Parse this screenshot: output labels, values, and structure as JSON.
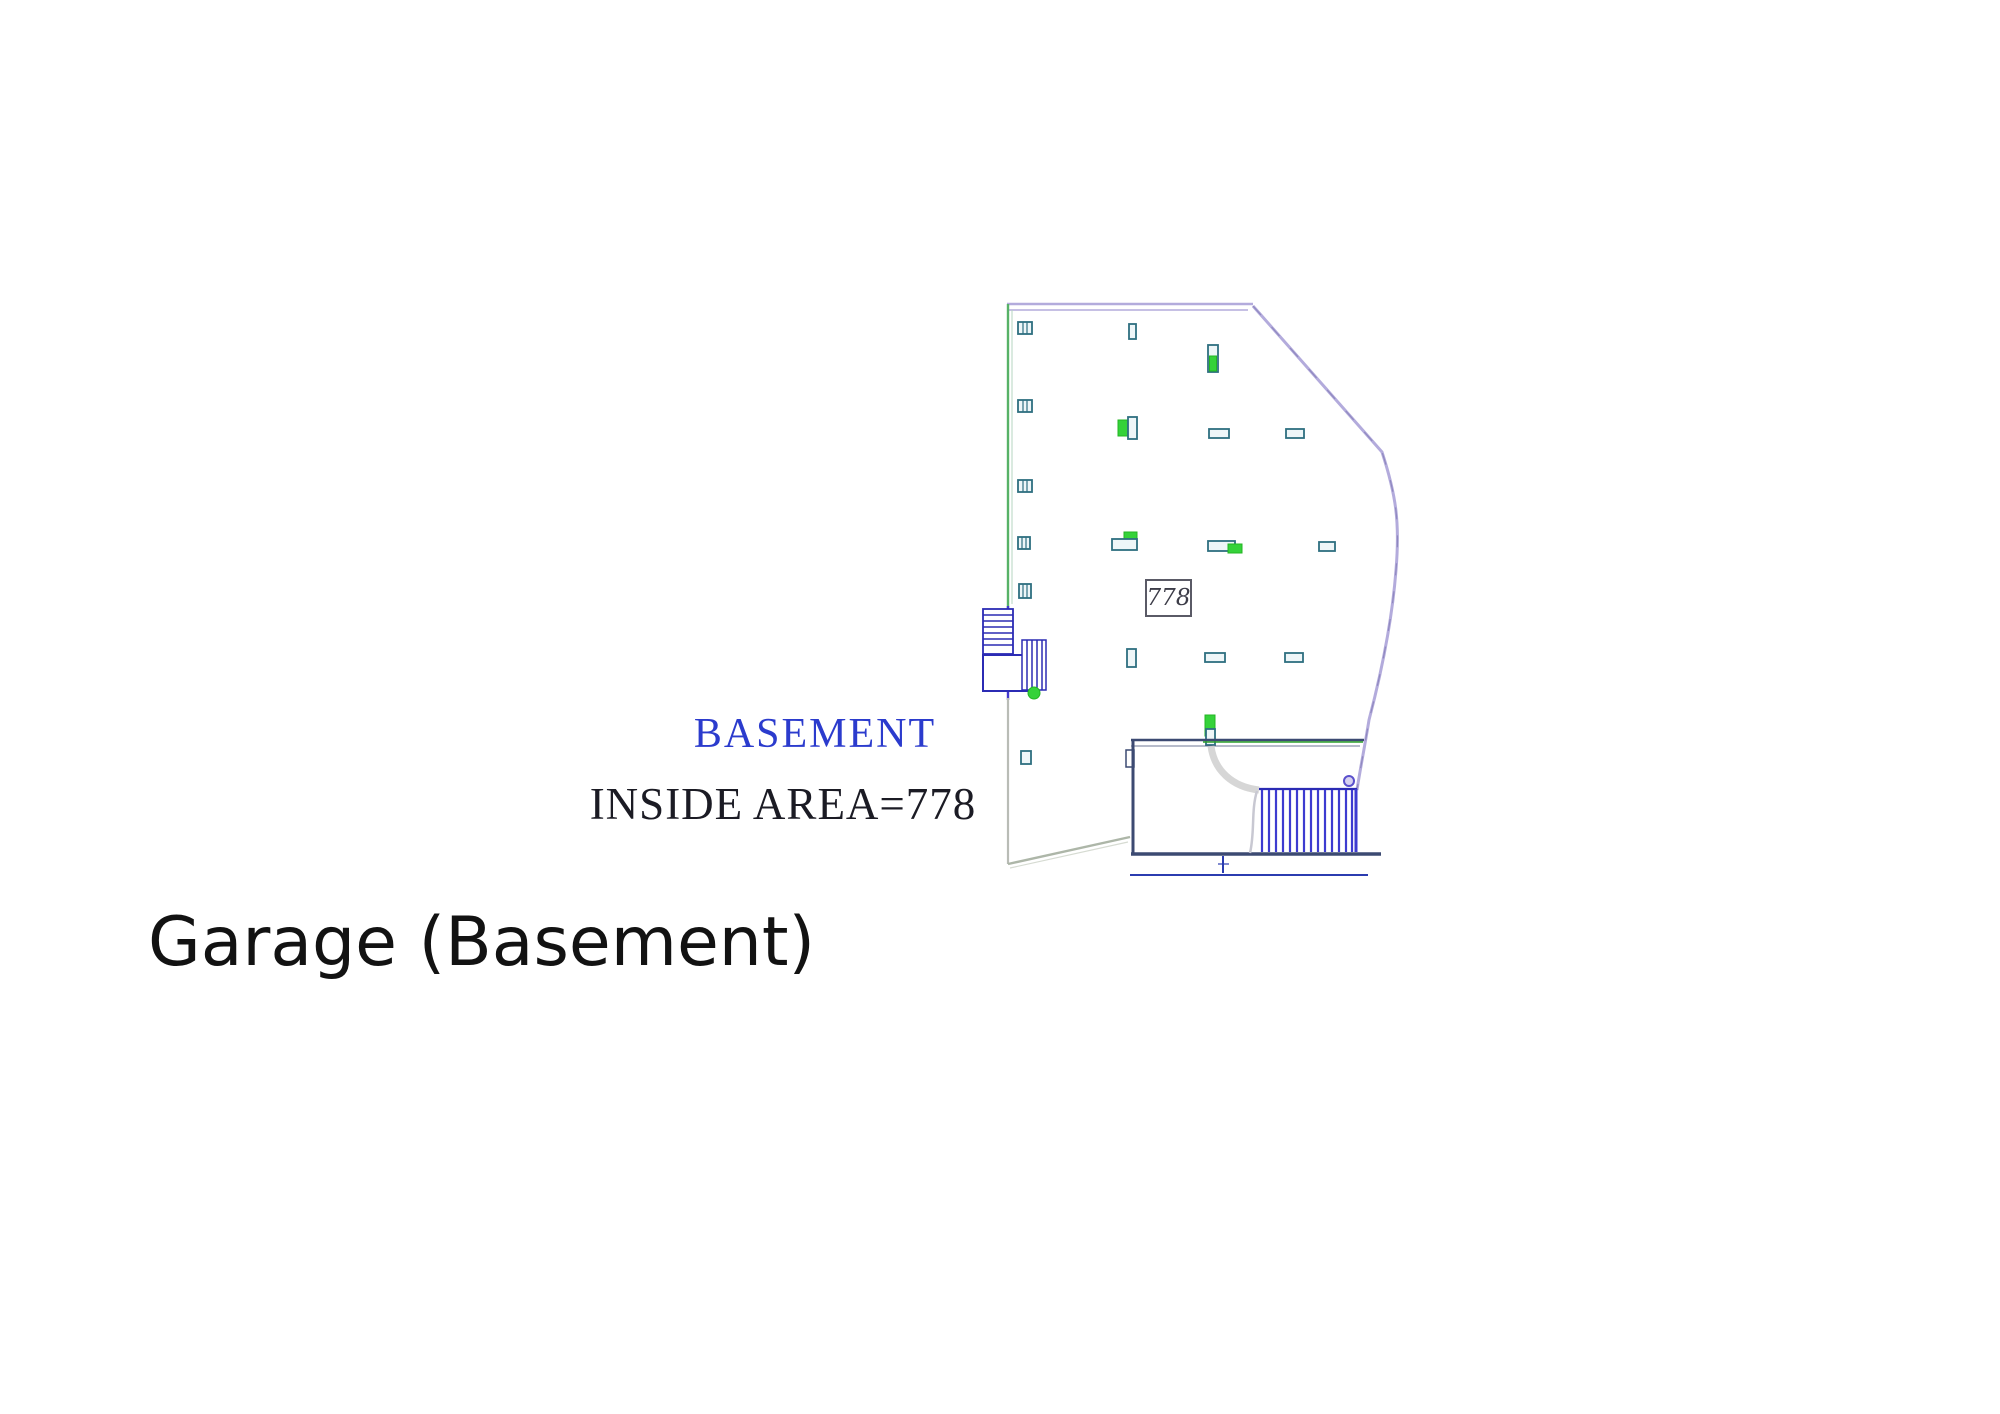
{
  "plan": {
    "labels": {
      "name": "BASEMENT",
      "area": "INSIDE AREA=778",
      "area_box": "778"
    },
    "caption": "Garage (Basement)",
    "colors": {
      "boundary_lavender": "#b3abdc",
      "boundary_accent": "#8f88bf",
      "wall_green": "#57b267",
      "wall_blue": "#4338cf",
      "wall_gray": "#b9bcb6",
      "diag_gray_green": "#adb6a8",
      "column_teal": "#2e6f80",
      "column_fill": "#eef6f8",
      "accent_green": "#35d23a",
      "accent_green_dark": "#23b523",
      "stair_blue": "#2b2bb4",
      "ramp_blue": "#3d3bd0",
      "room_wall": "#3c4a72",
      "line_green": "#2ca02c",
      "dim_blue": "#2b3cb0",
      "arc_gray": "#cfcfcf",
      "text_blue": "#2b3bcd",
      "text_dark": "#1b1b24",
      "caption_black": "#121212",
      "box_border": "#5a5a66",
      "box_text": "#3c3c48"
    }
  }
}
